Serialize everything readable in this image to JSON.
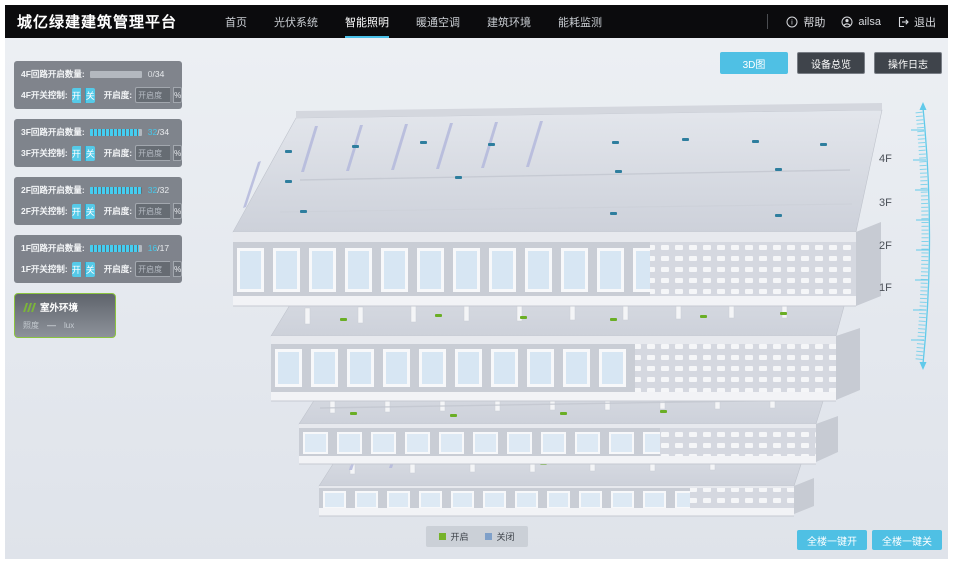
{
  "navbar": {
    "title": "城亿绿建建筑管理平台",
    "menu": [
      {
        "label": "首页"
      },
      {
        "label": "光伏系统"
      },
      {
        "label": "智能照明"
      },
      {
        "label": "暖通空调"
      },
      {
        "label": "建筑环境"
      },
      {
        "label": "能耗监测"
      }
    ],
    "help_label": "帮助",
    "user_name": "ailsa",
    "logout_label": "退出"
  },
  "sidebar": {
    "floor_panels": [
      {
        "floor": "4F",
        "count_label": "4F回路开启数量:",
        "count_current": "0",
        "count_total": "/34",
        "fill": "0%",
        "current_color": "#d7dbe0",
        "switch_label": "4F开关控制:",
        "btn_on": "开",
        "btn_off": "关",
        "openness_label": "开启度:",
        "openness_placeholder": "开启度",
        "percent_label": "%"
      },
      {
        "floor": "3F",
        "count_label": "3F回路开启数量:",
        "count_current": "32",
        "count_total": "/34",
        "fill": "94%",
        "current_color": "#45c9ec",
        "switch_label": "3F开关控制:",
        "btn_on": "开",
        "btn_off": "关",
        "openness_label": "开启度:",
        "openness_placeholder": "开启度",
        "percent_label": "%"
      },
      {
        "floor": "2F",
        "count_label": "2F回路开启数量:",
        "count_current": "32",
        "count_total": "/32",
        "fill": "100%",
        "current_color": "#45c9ec",
        "switch_label": "2F开关控制:",
        "btn_on": "开",
        "btn_off": "关",
        "openness_label": "开启度:",
        "openness_placeholder": "开启度",
        "percent_label": "%"
      },
      {
        "floor": "1F",
        "count_label": "1F回路开启数量:",
        "count_current": "16",
        "count_total": "/17",
        "fill": "94%",
        "current_color": "#45c9ec",
        "switch_label": "1F开关控制:",
        "btn_on": "开",
        "btn_off": "关",
        "openness_label": "开启度:",
        "openness_placeholder": "开启度",
        "percent_label": "%"
      }
    ],
    "outdoor_panel": {
      "title": "室外环境",
      "metric_label": "照度",
      "metric_value": "—",
      "metric_unit": "lux"
    }
  },
  "view_toolbar": {
    "buttons": [
      {
        "label": "3D图",
        "active": true
      },
      {
        "label": "设备总览",
        "active": false
      },
      {
        "label": "操作日志",
        "active": false
      }
    ]
  },
  "floor_axis": {
    "labels": [
      "4F",
      "3F",
      "2F",
      "1F"
    ]
  },
  "legend": {
    "on_label": "开启",
    "on_color": "#76b32a",
    "off_label": "关闭",
    "off_color": "#7fa0c9"
  },
  "footer_actions": {
    "all_on_label": "全楼一键开",
    "all_off_label": "全楼一键关"
  },
  "colors": {
    "accent_cyan": "#4fc0e4",
    "navbar_bg": "#0b0b0d",
    "content_bg": "#e6e9ef",
    "marker_on": "#6aae25",
    "marker_off": "#2e7e9e",
    "progress_cyan": "#45c9ec",
    "ruler_cyan": "#56c8ea"
  }
}
